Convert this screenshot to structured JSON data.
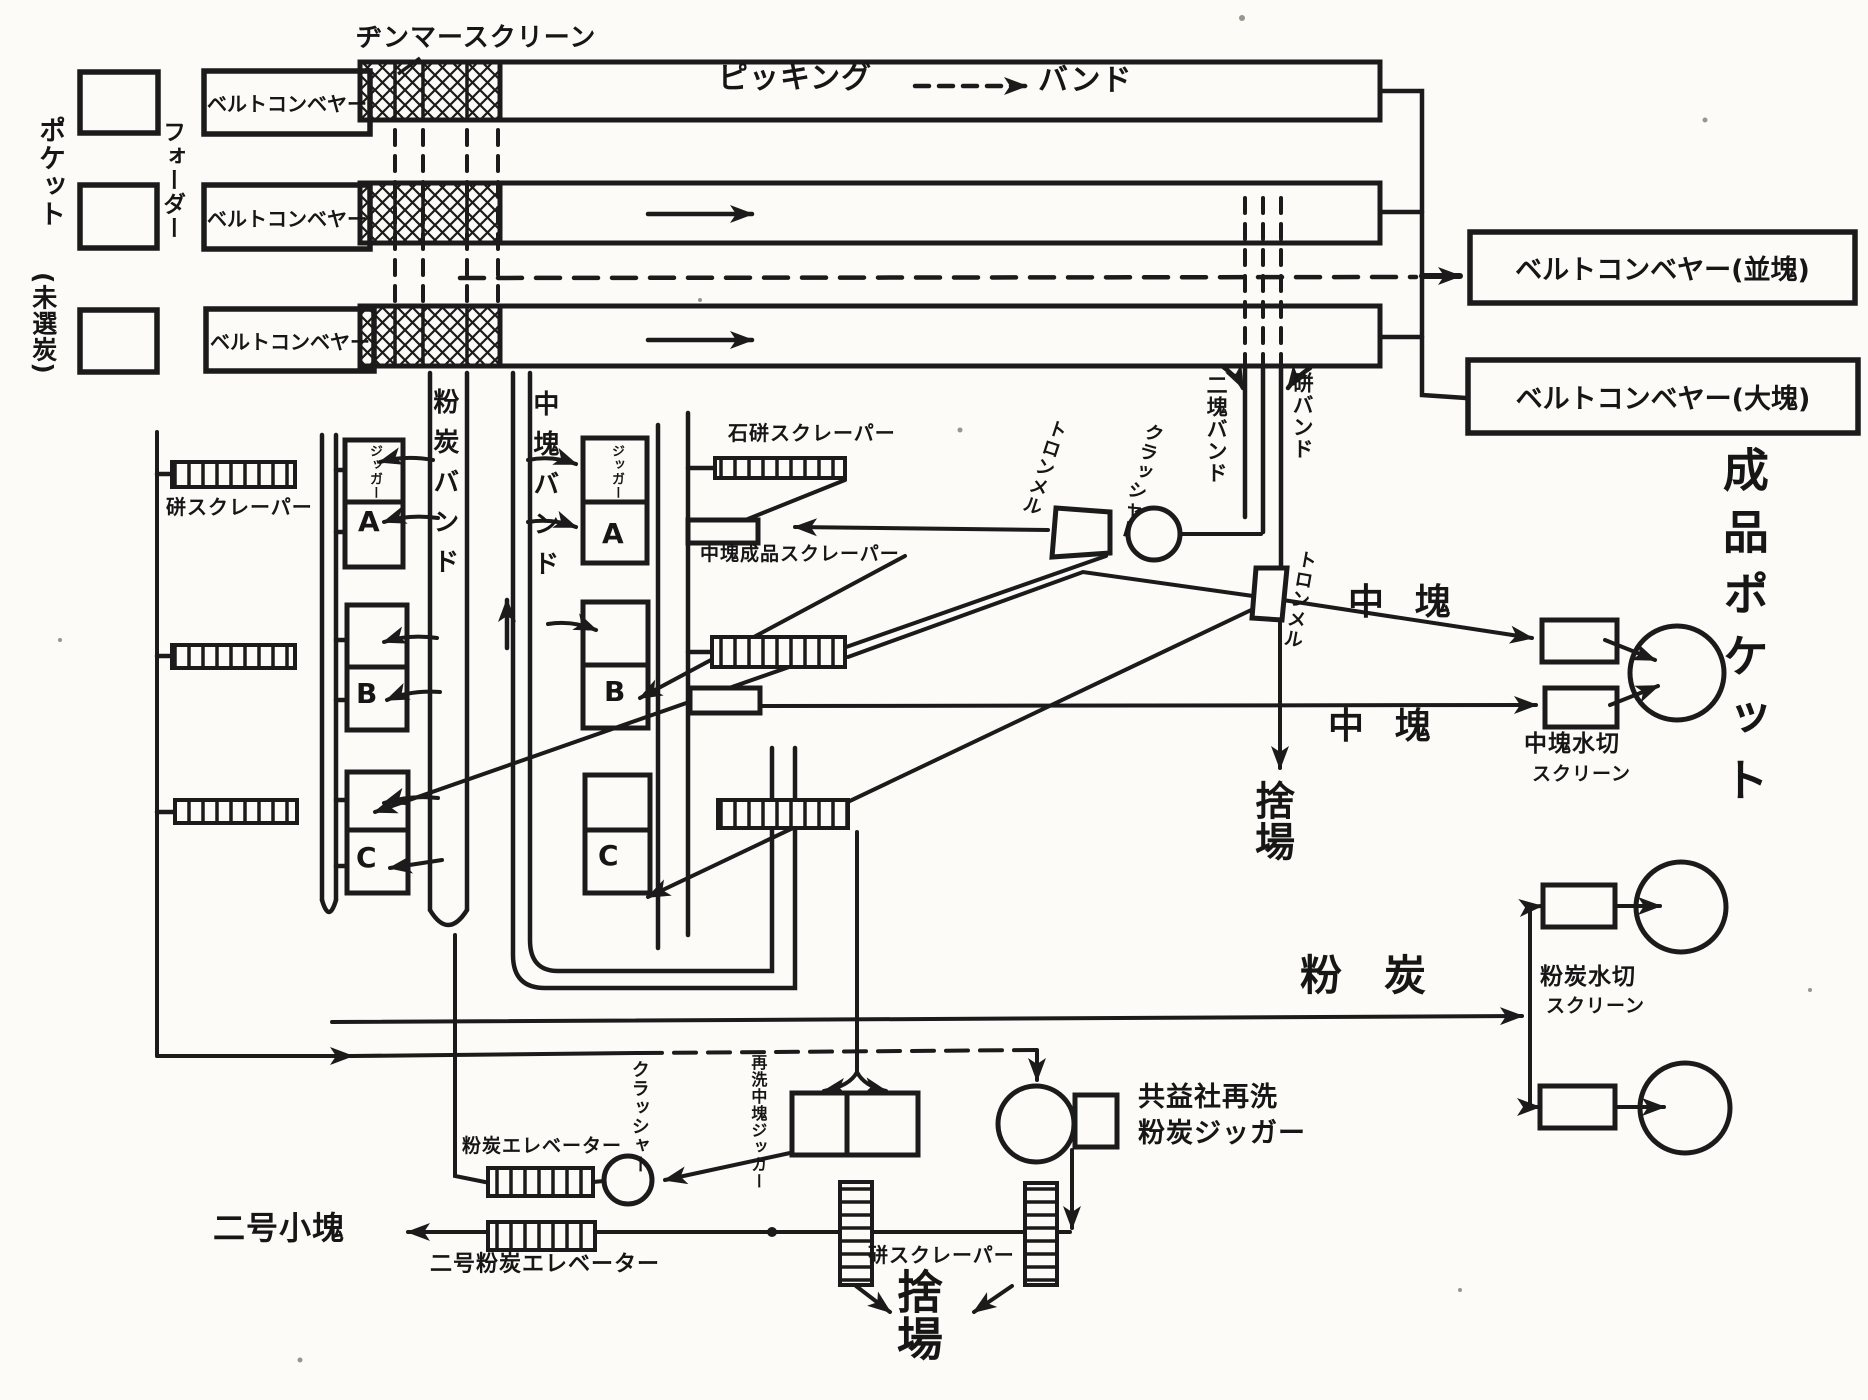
{
  "colors": {
    "ink": "#1b1b1b",
    "paper": "#fcfbf7"
  },
  "labels": {
    "pocket": "ポケット",
    "pocket_sub": "(未選炭)",
    "feeder": "フォーダー",
    "belt_conveyor": "ベルトコンベヤー",
    "jimmer_screen": "ヂンマースクリーン",
    "picking": "ピッキング",
    "band": "バンド",
    "bc_nami": "ベルトコンベヤー(並塊)",
    "bc_dai": "ベルトコンベヤー(大塊)",
    "nikai_band": "二塊バンド",
    "zuri_band": "硑バンド",
    "crusher": "クラッシャー",
    "trommel": "トロンメル",
    "zuri_scraper": "硑スクレーパー",
    "ishizuri_scraper": "石硑スクレーパー",
    "chukai_seihin_scraper": "中塊成品スクレーパー",
    "funtan_band": "粉炭バンド",
    "chukai_band": "中塊バンド",
    "jigger": "ジッガー",
    "cell_a": "A",
    "cell_b": "B",
    "cell_c": "C",
    "chukai": "中塊",
    "suteba": "捨場",
    "chukai_mizukiri": "中塊水切",
    "screen_word": "スクリーン",
    "funtan_mizukiri": "粉炭水切",
    "funtan": "粉炭",
    "seihin_pocket": "成品ポケット",
    "funtan_elevator": "粉炭エレベーター",
    "nigo_funtan_elevator": "二号粉炭エレベーター",
    "nigo_kokai": "二号小塊",
    "saisen_chukai_jigger": "再洗中塊ジッガー",
    "kyoekisha_1": "共益社再洗",
    "kyoekisha_2": "粉炭ジッガー"
  }
}
